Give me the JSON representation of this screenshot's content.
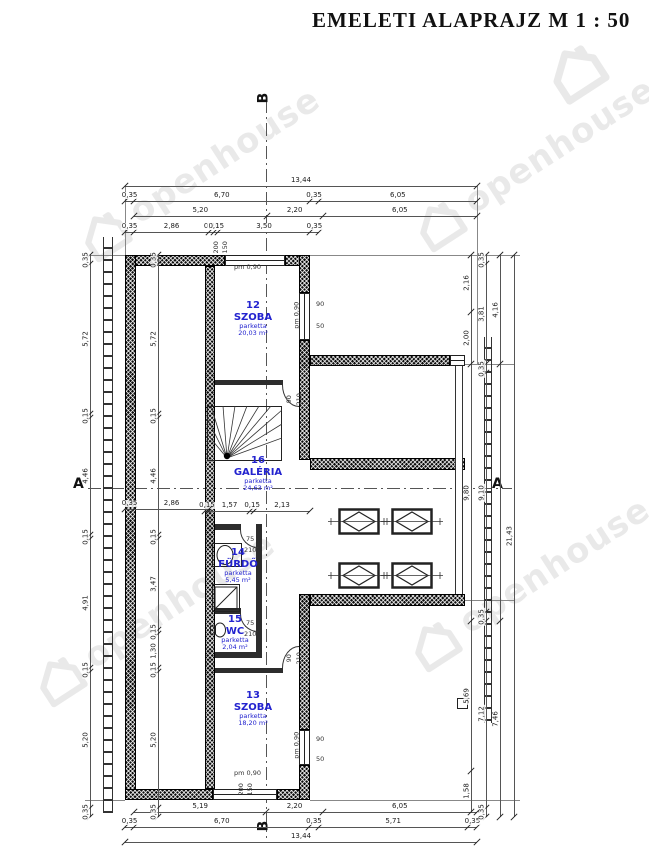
{
  "title": "EMELETI ALAPRAJZ M 1 : 50",
  "watermark": {
    "text": "openhouse"
  },
  "colors": {
    "label_blue": "#2323cf",
    "wall": "#0c0c0c",
    "dim_line": "#555555"
  },
  "section_markers": {
    "a_left": "A",
    "a_right": "A",
    "b_top": "B",
    "b_bottom": "B"
  },
  "rooms": [
    {
      "number": "12",
      "name": "SZOBA",
      "material": "parketta",
      "area": "20,03 m²"
    },
    {
      "number": "16",
      "name": "GALÉRIA",
      "material": "parketta",
      "area": "24,63 m²"
    },
    {
      "number": "14",
      "name": "FÜRDŐ",
      "material": "parketta",
      "area": "5,45 m²"
    },
    {
      "number": "15",
      "name": "WC",
      "material": "parketta",
      "area": "2,04 m²"
    },
    {
      "number": "13",
      "name": "SZOBA",
      "material": "parketta",
      "area": "18,20 m²"
    }
  ],
  "openings": {
    "top_window": {
      "pm": "pm 0,90",
      "w": "200",
      "h": "150"
    },
    "bottom_window": {
      "pm": "pm 0,90",
      "w": "200",
      "h": "150"
    },
    "room12_window": {
      "pm": "pm 0,90",
      "w": "90",
      "h": "50"
    },
    "room13_window": {
      "pm": "pm 0,90",
      "w": "90",
      "h": "50"
    },
    "bath_door": {
      "w": "75",
      "h": "210"
    },
    "wc_door": {
      "w": "75",
      "h": "210"
    },
    "room12_door": {
      "w": "90",
      "h": "210"
    },
    "room13_door": {
      "w": "90",
      "h": "210"
    }
  },
  "dimensions": {
    "chains": [
      {
        "id": "top-1",
        "orient": "h",
        "x": 125,
        "y": 186,
        "len": 352,
        "segments": [
          {
            "t": "13,44",
            "v": 13.44
          }
        ]
      },
      {
        "id": "top-2",
        "orient": "h",
        "x": 125,
        "y": 201,
        "len": 352,
        "segments": [
          {
            "t": "0,35",
            "v": 0.35
          },
          {
            "t": "6,70",
            "v": 6.7
          },
          {
            "t": "0,35",
            "v": 0.35
          },
          {
            "t": "6,05",
            "v": 6.05
          }
        ]
      },
      {
        "id": "top-3",
        "orient": "h",
        "x": 134,
        "y": 216,
        "len": 343,
        "segments": [
          {
            "t": "5,20",
            "v": 5.2
          },
          {
            "t": "2,20",
            "v": 2.2
          },
          {
            "t": "6,05",
            "v": 6.05
          }
        ]
      },
      {
        "id": "top-4",
        "orient": "h",
        "x": 125,
        "y": 232,
        "len": 194,
        "segments": [
          {
            "t": "0,35",
            "v": 0.35
          },
          {
            "t": "2,86",
            "v": 2.86
          },
          {
            "t": "0,20",
            "v": 0.2
          },
          {
            "t": "0,15",
            "v": 0.15
          },
          {
            "t": "3,50",
            "v": 3.5
          },
          {
            "t": "0,35",
            "v": 0.35
          }
        ]
      },
      {
        "id": "bottom-1",
        "orient": "h",
        "x": 134,
        "y": 812,
        "len": 343,
        "segments": [
          {
            "t": "5,19",
            "v": 5.19
          },
          {
            "t": "2,20",
            "v": 2.2
          },
          {
            "t": "6,05",
            "v": 6.05
          }
        ]
      },
      {
        "id": "bottom-2",
        "orient": "h",
        "x": 125,
        "y": 827,
        "len": 352,
        "segments": [
          {
            "t": "0,35",
            "v": 0.35
          },
          {
            "t": "6,70",
            "v": 6.7
          },
          {
            "t": "0,35",
            "v": 0.35
          },
          {
            "t": "5,71",
            "v": 5.71
          },
          {
            "t": "0,35",
            "v": 0.35
          }
        ]
      },
      {
        "id": "bottom-3",
        "orient": "h",
        "x": 125,
        "y": 842,
        "len": 352,
        "segments": [
          {
            "t": "13,44",
            "v": 13.44
          }
        ]
      },
      {
        "id": "left-outer",
        "orient": "v",
        "x": 90,
        "y": 255,
        "len": 562,
        "segments": [
          {
            "t": "0,35",
            "v": 0.35
          },
          {
            "t": "5,72",
            "v": 5.72
          },
          {
            "t": "0,15",
            "v": 0.15
          },
          {
            "t": "4,46",
            "v": 4.46
          },
          {
            "t": "0,15",
            "v": 0.15
          },
          {
            "t": "4,91",
            "v": 4.91
          },
          {
            "t": "0,15",
            "v": 0.15
          },
          {
            "t": "5,20",
            "v": 5.2
          },
          {
            "t": "0,35",
            "v": 0.35
          }
        ]
      },
      {
        "id": "left-inner",
        "orient": "v",
        "x": 158,
        "y": 255,
        "len": 562,
        "segments": [
          {
            "t": "0,35",
            "v": 0.35
          },
          {
            "t": "5,72",
            "v": 5.72
          },
          {
            "t": "0,15",
            "v": 0.15
          },
          {
            "t": "4,46",
            "v": 4.46
          },
          {
            "t": "0,15",
            "v": 0.15
          },
          {
            "t": "3,47",
            "v": 3.47
          },
          {
            "t": "0,15",
            "v": 0.15
          },
          {
            "t": "1,30",
            "v": 1.3
          },
          {
            "t": "0,15",
            "v": 0.15
          },
          {
            "t": "5,20",
            "v": 5.2
          },
          {
            "t": "0,35",
            "v": 0.35
          }
        ]
      },
      {
        "id": "right-1",
        "orient": "v",
        "x": 471,
        "y": 255,
        "len": 557,
        "segments": [
          {
            "t": "2,16",
            "v": 2.16
          },
          {
            "t": "2,00",
            "v": 2.0
          },
          {
            "t": "9,80",
            "v": 9.8
          },
          {
            "t": "5,69",
            "v": 5.69
          },
          {
            "t": "1,58",
            "v": 1.58
          }
        ]
      },
      {
        "id": "right-2",
        "orient": "v",
        "x": 486,
        "y": 255,
        "len": 562,
        "segments": [
          {
            "t": "0,35",
            "v": 0.35
          },
          {
            "t": "3,81",
            "v": 3.81
          },
          {
            "t": "0,35",
            "v": 0.35
          },
          {
            "t": "9,10",
            "v": 9.1
          },
          {
            "t": "0,35",
            "v": 0.35
          },
          {
            "t": "7,12",
            "v": 7.12
          },
          {
            "t": "0,35",
            "v": 0.35
          }
        ]
      },
      {
        "id": "right-3",
        "orient": "v",
        "x": 500,
        "y": 255,
        "len": 562,
        "segments": [
          {
            "t": "4,16",
            "v": 4.16
          },
          {
            "t": "",
            "v": 9.81
          },
          {
            "t": "7,46",
            "v": 7.46
          }
        ]
      },
      {
        "id": "right-4",
        "orient": "v",
        "x": 514,
        "y": 255,
        "len": 562,
        "segments": [
          {
            "t": "21,43",
            "v": 21.43
          }
        ]
      },
      {
        "id": "galleria",
        "orient": "h",
        "x": 205,
        "y": 511,
        "len": 105,
        "segments": [
          {
            "t": "0,15",
            "v": 0.15
          },
          {
            "t": "1,57",
            "v": 1.57
          },
          {
            "t": "0,15",
            "v": 0.15
          },
          {
            "t": "2,13",
            "v": 2.13
          }
        ]
      },
      {
        "id": "section-left",
        "orient": "h",
        "x": 125,
        "y": 509,
        "len": 84,
        "segments": [
          {
            "t": "0,35",
            "v": 0.35
          },
          {
            "t": "2,86",
            "v": 2.86
          }
        ]
      }
    ]
  }
}
